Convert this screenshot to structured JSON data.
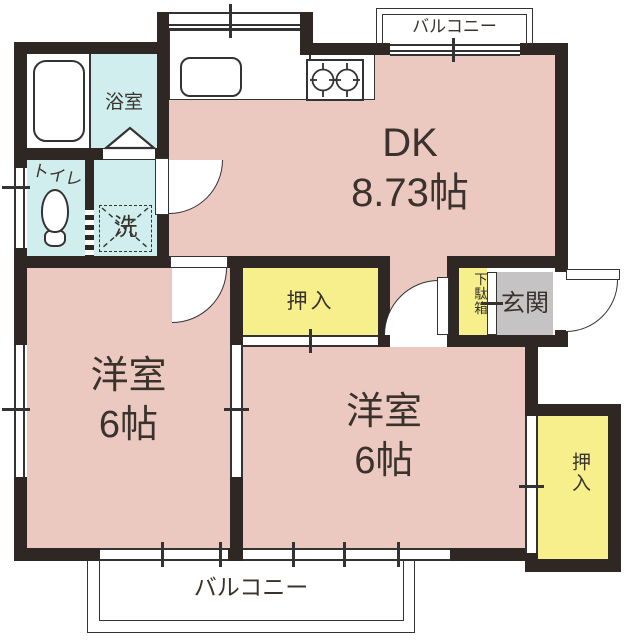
{
  "plan_type": "apartment-floor-plan",
  "colors": {
    "room_floor": "#ecc9c0",
    "wet_area": "#cfeeed",
    "closet": "#f6ef8b",
    "entrance_floor": "#c5c3c4",
    "wall": "#2e2723",
    "line": "#333333"
  },
  "rooms": {
    "dk": {
      "label": "DK",
      "size": "8.73帖"
    },
    "bathroom": {
      "label": "浴室"
    },
    "toilet": {
      "label": "トイレ"
    },
    "laundry": {
      "label": "洗"
    },
    "western_room_left": {
      "label": "洋室",
      "size": "6帖"
    },
    "western_room_right": {
      "label": "洋室",
      "size": "6帖"
    },
    "closet_center": {
      "label": "押入"
    },
    "closet_right": {
      "label": "押入"
    },
    "shoe_cabinet": {
      "label": "下駄箱"
    },
    "entrance": {
      "label": "玄関"
    },
    "balcony_north": {
      "label": "バルコニー"
    },
    "balcony_south": {
      "label": "バルコニー"
    }
  }
}
